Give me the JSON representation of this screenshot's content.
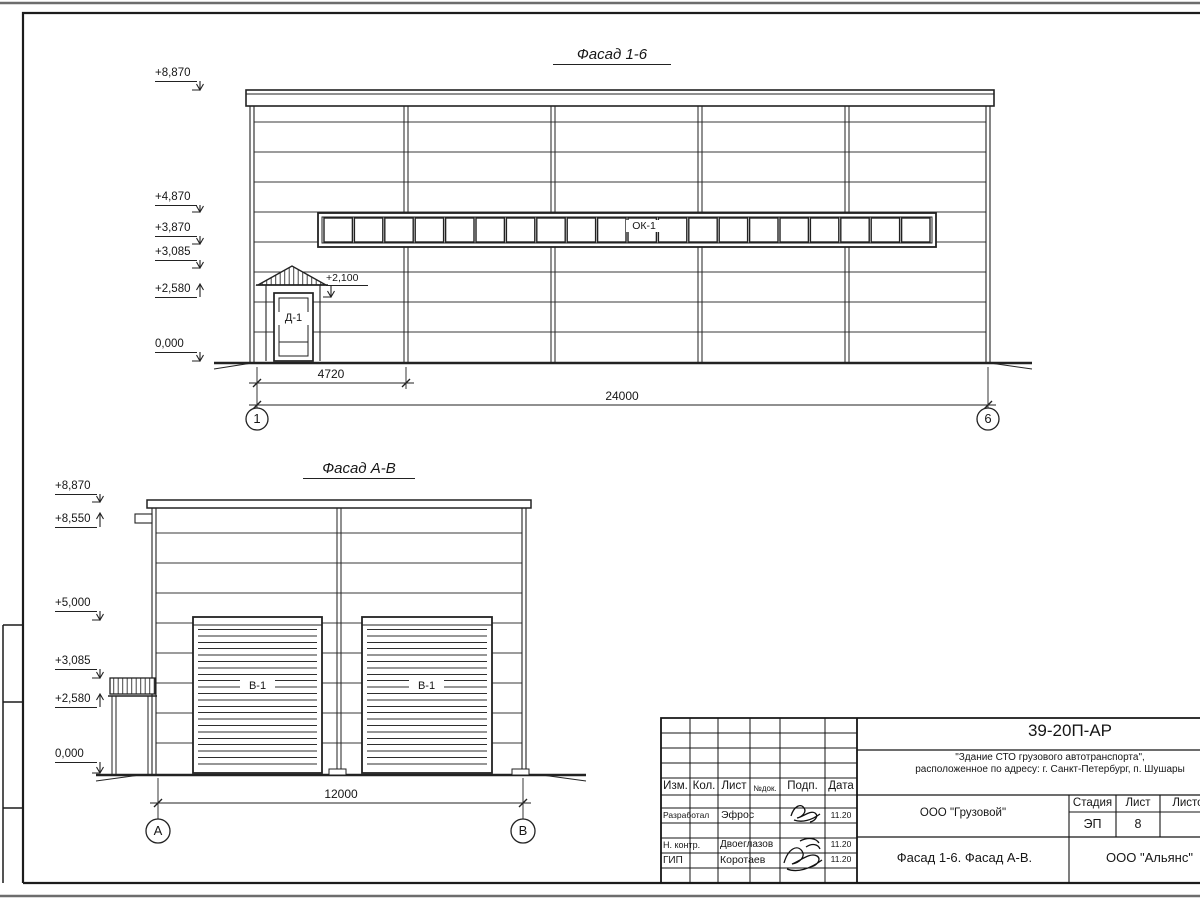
{
  "sheet": {
    "facade16": {
      "title": "Фасад 1-6",
      "elevations": [
        "+8,870",
        "+4,870",
        "+3,870",
        "+3,085",
        "+2,580",
        "0,000"
      ],
      "canopy_mark": "+2,100",
      "window_label": "ОК-1",
      "window_pane_count": 20,
      "door_label": "Д-1",
      "dim_bay": "4720",
      "dim_total": "24000",
      "axis_left": "1",
      "axis_right": "6"
    },
    "facadeAB": {
      "title": "Фасад А-В",
      "elevations": [
        "+8,870",
        "+8,550",
        "+5,000",
        "+3,085",
        "+2,580",
        "0,000"
      ],
      "door_label": "В-1",
      "dim_total": "12000",
      "axis_left": "А",
      "axis_right": "В"
    },
    "titleblock": {
      "doc_number": "39-20П-АР",
      "project_line1": "\"Здание СТО грузового автотранспорта\",",
      "project_line2": "расположенное по адресу: г. Санкт-Петербург, п. Шушары",
      "client": "ООО \"Грузовой\"",
      "sheet_title": "Фасад 1-6. Фасад А-В.",
      "company": "ООО \"Альянс\"",
      "stage_label": "Стадия",
      "sheet_label": "Лист",
      "sheets_label": "Листов",
      "stage_value": "ЭП",
      "sheet_value": "8",
      "header_cols": [
        "Изм.",
        "Кол.",
        "Лист",
        "№док.",
        "Подп.",
        "Дата"
      ],
      "rows": [
        {
          "role": "Разработал",
          "name": "Эфрос",
          "date": "11.20"
        },
        {
          "role": "Н. контр.",
          "name": "Двоеглазов",
          "date": "11.20"
        },
        {
          "role": "ГИП",
          "name": "Коротаев",
          "date": "11.20"
        }
      ]
    }
  }
}
